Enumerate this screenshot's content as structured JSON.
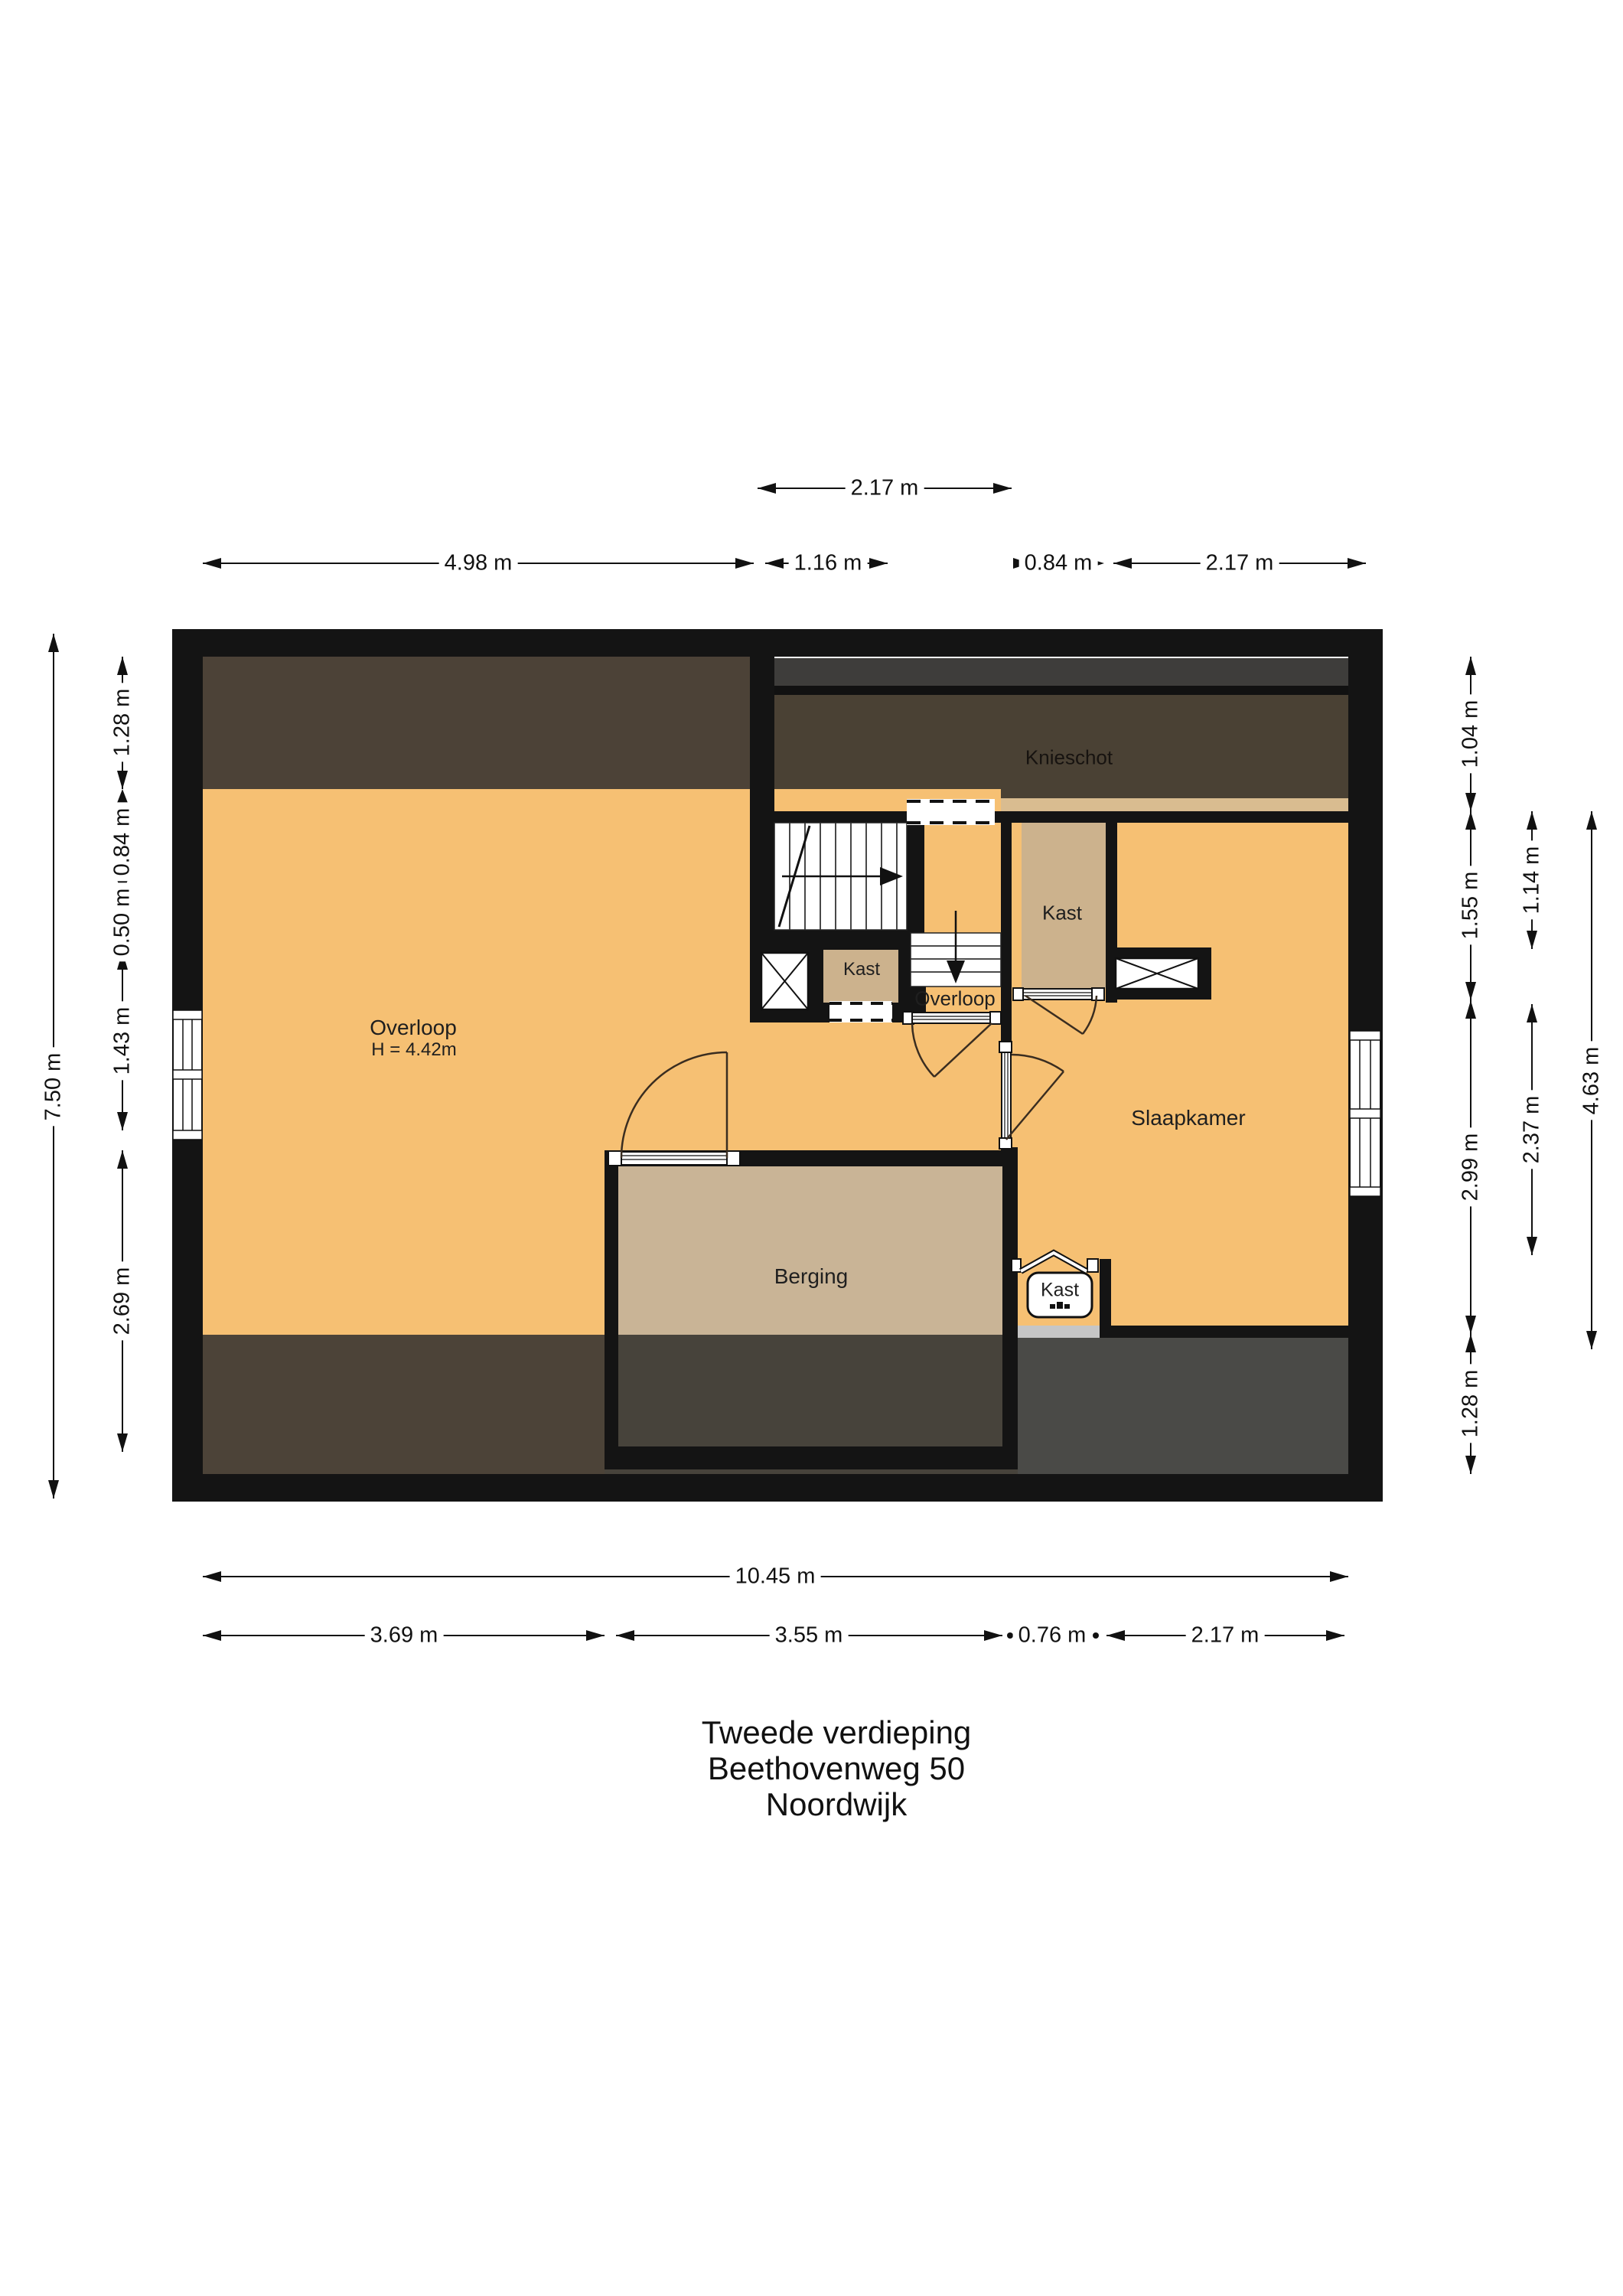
{
  "title": {
    "lines": [
      "Tweede verdieping",
      "Beethovenweg 50",
      "Noordwijk"
    ]
  },
  "floorplan": {
    "rooms": {
      "knieschot": "Knieschot",
      "kast_top": "Kast",
      "kast_mid": "Kast",
      "overloop_small": "Overloop",
      "overloop": "Overloop",
      "overloop_height": "H = 4.42m",
      "slaapkamer": "Slaapkamer",
      "berging": "Berging",
      "kast_bottom": "Kast"
    },
    "features": [
      "stairs-up-arrow",
      "stairs-down-arrow",
      "shaft-x-symbol",
      "chimney-x-symbol",
      "window-left",
      "window-right",
      "dashed-opening",
      "folding-door"
    ]
  },
  "dimensions": {
    "top": [
      "2.17 m"
    ],
    "upper": [
      "4.98 m",
      "1.16 m",
      "0.84 m",
      "2.17 m"
    ],
    "left_outer": "7.50 m",
    "left_inner": [
      "1.28 m",
      "0.84 m",
      "0.50 m",
      "1.43 m",
      "2.69 m"
    ],
    "right_inner": [
      "1.04 m",
      "1.55 m",
      "2.99 m",
      "1.28 m"
    ],
    "right_mid": [
      "1.14 m",
      "2.37 m"
    ],
    "right_outer": "4.63 m",
    "bottom_total": "10.45 m",
    "bottom": [
      "3.69 m",
      "3.55 m",
      "0.76 m",
      "2.17 m"
    ]
  },
  "colors": {
    "floor_orange": "#f6c073",
    "closet_tan": "#ccb28d",
    "berging_tan": "#c9b496",
    "knee_brown": "#4a4134",
    "left_band_brown": "#4c4237",
    "bottom_left_brown": "#4c4338",
    "bottom_mid_gray": "#47433b",
    "bottom_right_gray": "#4a4a47",
    "top_gray_strip": "#3e3d3b",
    "tan_strip": "#d9bc90",
    "wall_black": "#141414",
    "light_gray_step": "#c6c6c6"
  }
}
